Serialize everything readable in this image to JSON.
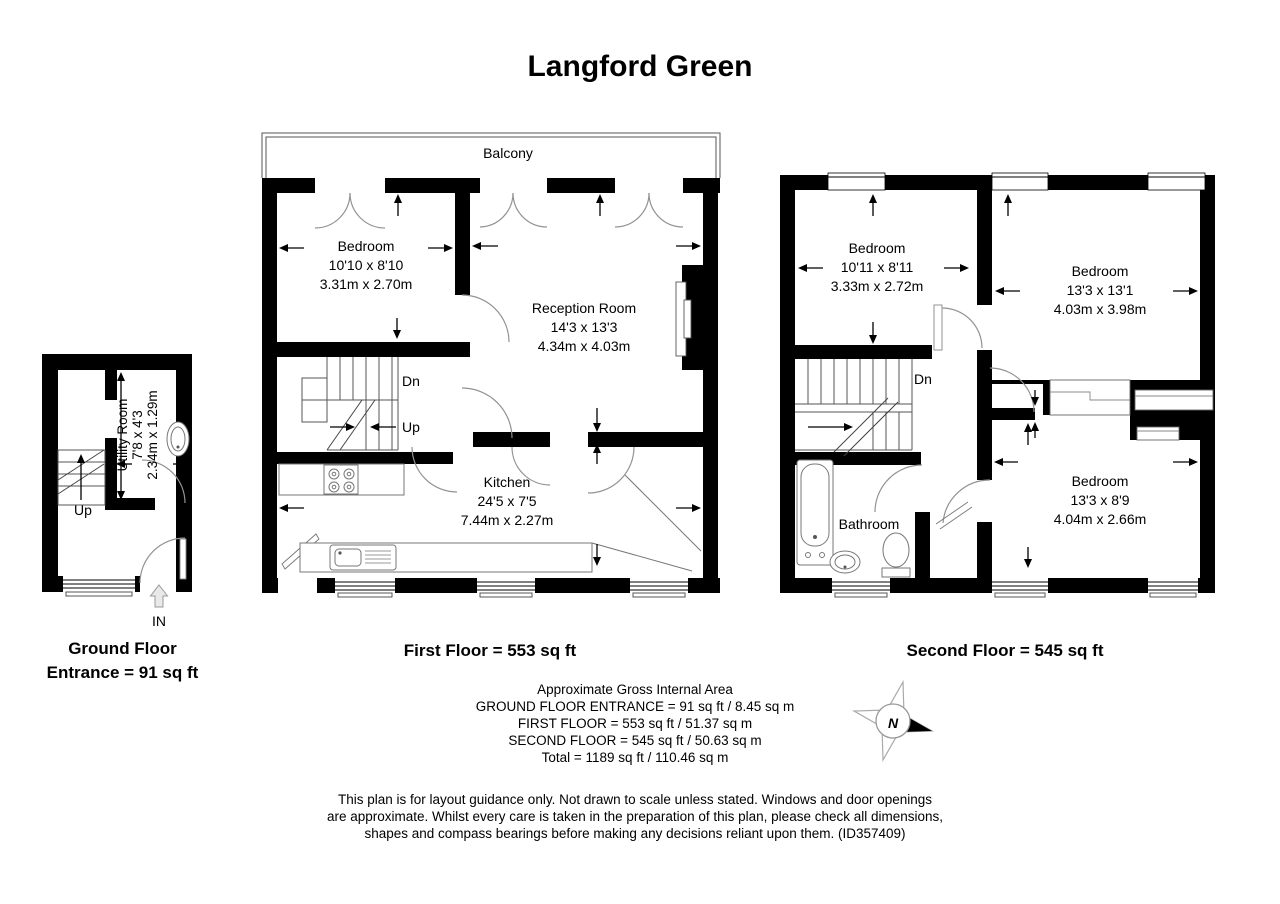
{
  "title": "Langford Green",
  "colors": {
    "walls": "#000000",
    "background": "#ffffff",
    "door_arc": "#929292"
  },
  "ground_floor": {
    "caption_line1": "Ground Floor",
    "caption_line2": "Entrance = 91 sq ft",
    "utility_room": {
      "name": "Utility Room",
      "imperial": "7'8 x 4'3",
      "metric": "2.34m x 1.29m"
    },
    "up_label": "Up",
    "in_label": "IN"
  },
  "first_floor": {
    "caption": "First Floor = 553 sq ft",
    "balcony_label": "Balcony",
    "bedroom": {
      "name": "Bedroom",
      "imperial": "10'10 x 8'10",
      "metric": "3.31m x 2.70m"
    },
    "reception": {
      "name": "Reception Room",
      "imperial": "14'3 x 13'3",
      "metric": "4.34m x 4.03m"
    },
    "kitchen": {
      "name": "Kitchen",
      "imperial": "24'5 x 7'5",
      "metric": "7.44m x 2.27m"
    },
    "dn_label": "Dn",
    "up_label": "Up"
  },
  "second_floor": {
    "caption": "Second Floor = 545 sq ft",
    "bedroom1": {
      "name": "Bedroom",
      "imperial": "10'11 x 8'11",
      "metric": "3.33m x 2.72m"
    },
    "bedroom2": {
      "name": "Bedroom",
      "imperial": "13'3 x 13'1",
      "metric": "4.03m x 3.98m"
    },
    "bedroom3": {
      "name": "Bedroom",
      "imperial": "13'3 x 8'9",
      "metric": "4.04m x 2.66m"
    },
    "bathroom_label": "Bathroom",
    "dn_label": "Dn"
  },
  "area_summary": {
    "heading": "Approximate Gross Internal Area",
    "ground": "GROUND FLOOR ENTRANCE = 91 sq ft / 8.45 sq m",
    "first": "FIRST FLOOR = 553 sq ft / 51.37 sq m",
    "second": "SECOND FLOOR = 545 sq ft / 50.63 sq m",
    "total": "Total = 1189 sq ft / 110.46 sq m"
  },
  "compass": {
    "north": "N"
  },
  "disclaimer": {
    "line1": "This plan is for layout guidance only. Not drawn to scale unless stated. Windows and door openings",
    "line2": "are approximate. Whilst every care is taken in the preparation of this plan, please check all dimensions,",
    "line3": "shapes and compass bearings before making any decisions reliant upon them. (ID357409)"
  }
}
